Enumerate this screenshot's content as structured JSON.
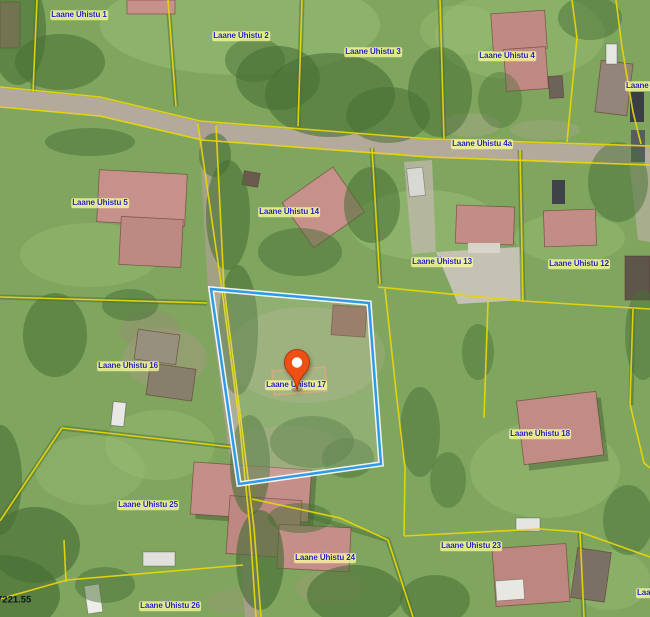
{
  "app": {
    "type": "cadastral-aerial-map-viewer"
  },
  "map": {
    "selected_parcel": {
      "label": "Laane Ühistu 17",
      "outline_color": "#2E9BE6"
    },
    "marker": {
      "name": "location-pin",
      "x": 297,
      "y": 391,
      "color": "#ED4F14",
      "associated_label": "Laane Ühistu 17"
    },
    "colors": {
      "boundary_yellow": "#E8D50A",
      "selection_blue": "#2E9BE6",
      "label_text": "#2121C8",
      "label_halo": "#FFFF9E",
      "pin_orange": "#ED4F14",
      "measure_text": "#0E1A14"
    },
    "labels": [
      {
        "text": "Laane Ühistu 1",
        "x": 79,
        "y": 15
      },
      {
        "text": "Laane Ühistu 2",
        "x": 241,
        "y": 36
      },
      {
        "text": "Laane Ühistu 3",
        "x": 373,
        "y": 52
      },
      {
        "text": "Laane Ühistu 4",
        "x": 507,
        "y": 56
      },
      {
        "text": "Laane Ühistu",
        "x": 625,
        "y": 86,
        "anchor": "left"
      },
      {
        "text": "Laane Ühistu 4a",
        "x": 482,
        "y": 144
      },
      {
        "text": "Laane Ühistu 5",
        "x": 100,
        "y": 203
      },
      {
        "text": "Laane Ühistu 14",
        "x": 289,
        "y": 212
      },
      {
        "text": "Laane Ühistu 13",
        "x": 442,
        "y": 262
      },
      {
        "text": "Laane Ühistu 12",
        "x": 579,
        "y": 264
      },
      {
        "text": "Laane Ühistu 16",
        "x": 128,
        "y": 366
      },
      {
        "text": "Laane Ühistu 17",
        "x": 296,
        "y": 385
      },
      {
        "text": "Laane Ühistu 18",
        "x": 540,
        "y": 434
      },
      {
        "text": "Laane Ühistu 25",
        "x": 148,
        "y": 505
      },
      {
        "text": "Laane Ühistu 24",
        "x": 325,
        "y": 558
      },
      {
        "text": "Laane Ühistu 23",
        "x": 471,
        "y": 546
      },
      {
        "text": "Laane Ühistu 26",
        "x": 170,
        "y": 606
      },
      {
        "text": "Laane Ühistu",
        "x": 636,
        "y": 593,
        "anchor": "left"
      },
      {
        "text": "7221.55",
        "x": -4,
        "y": 600,
        "anchor": "left",
        "variant": "measure"
      }
    ]
  }
}
